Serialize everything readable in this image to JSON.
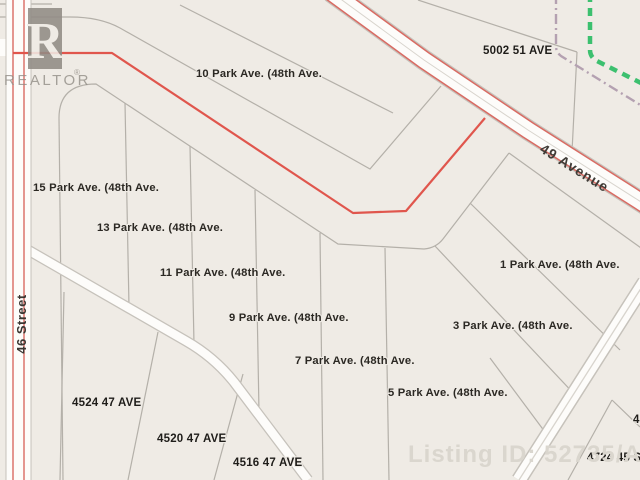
{
  "map": {
    "parcel_labels": [
      {
        "text": "10 Park Ave. (48th Ave."
      },
      {
        "text": "15 Park Ave. (48th Ave."
      },
      {
        "text": "13 Park Ave. (48th Ave."
      },
      {
        "text": "11 Park Ave. (48th Ave."
      },
      {
        "text": "9 Park Ave. (48th Ave."
      },
      {
        "text": "7 Park Ave. (48th Ave."
      },
      {
        "text": "5 Park Ave. (48th Ave."
      },
      {
        "text": "1 Park Ave. (48th Ave."
      },
      {
        "text": "3 Park Ave. (48th Ave."
      },
      {
        "text": "4524 47 AVE"
      },
      {
        "text": "4520 47 AVE"
      },
      {
        "text": "4516 47 AVE"
      },
      {
        "text": "5002 51 AVE"
      },
      {
        "text": "4724 45 St"
      },
      {
        "text": "4"
      }
    ],
    "street_labels": {
      "street_46": "46 Street",
      "avenue_49": "49 Avenue"
    },
    "watermarks": {
      "realtor_letter": "R",
      "realtor_text": "REALTOR",
      "registered_mark": "®",
      "listing_id": "Listing ID: 52735/AWBA"
    },
    "colors": {
      "background": "#efebe5",
      "road_fill": "#fdfcfa",
      "road_casing": "#c6c2bb",
      "parcel_line": "#b4b0a9",
      "boundary_red": "#e0564d",
      "road_edge_red": "#d96b63",
      "utility_green": "#3cc06f",
      "utility_purple": "#b4a1b1",
      "watermark_gray": "#918c85"
    }
  }
}
